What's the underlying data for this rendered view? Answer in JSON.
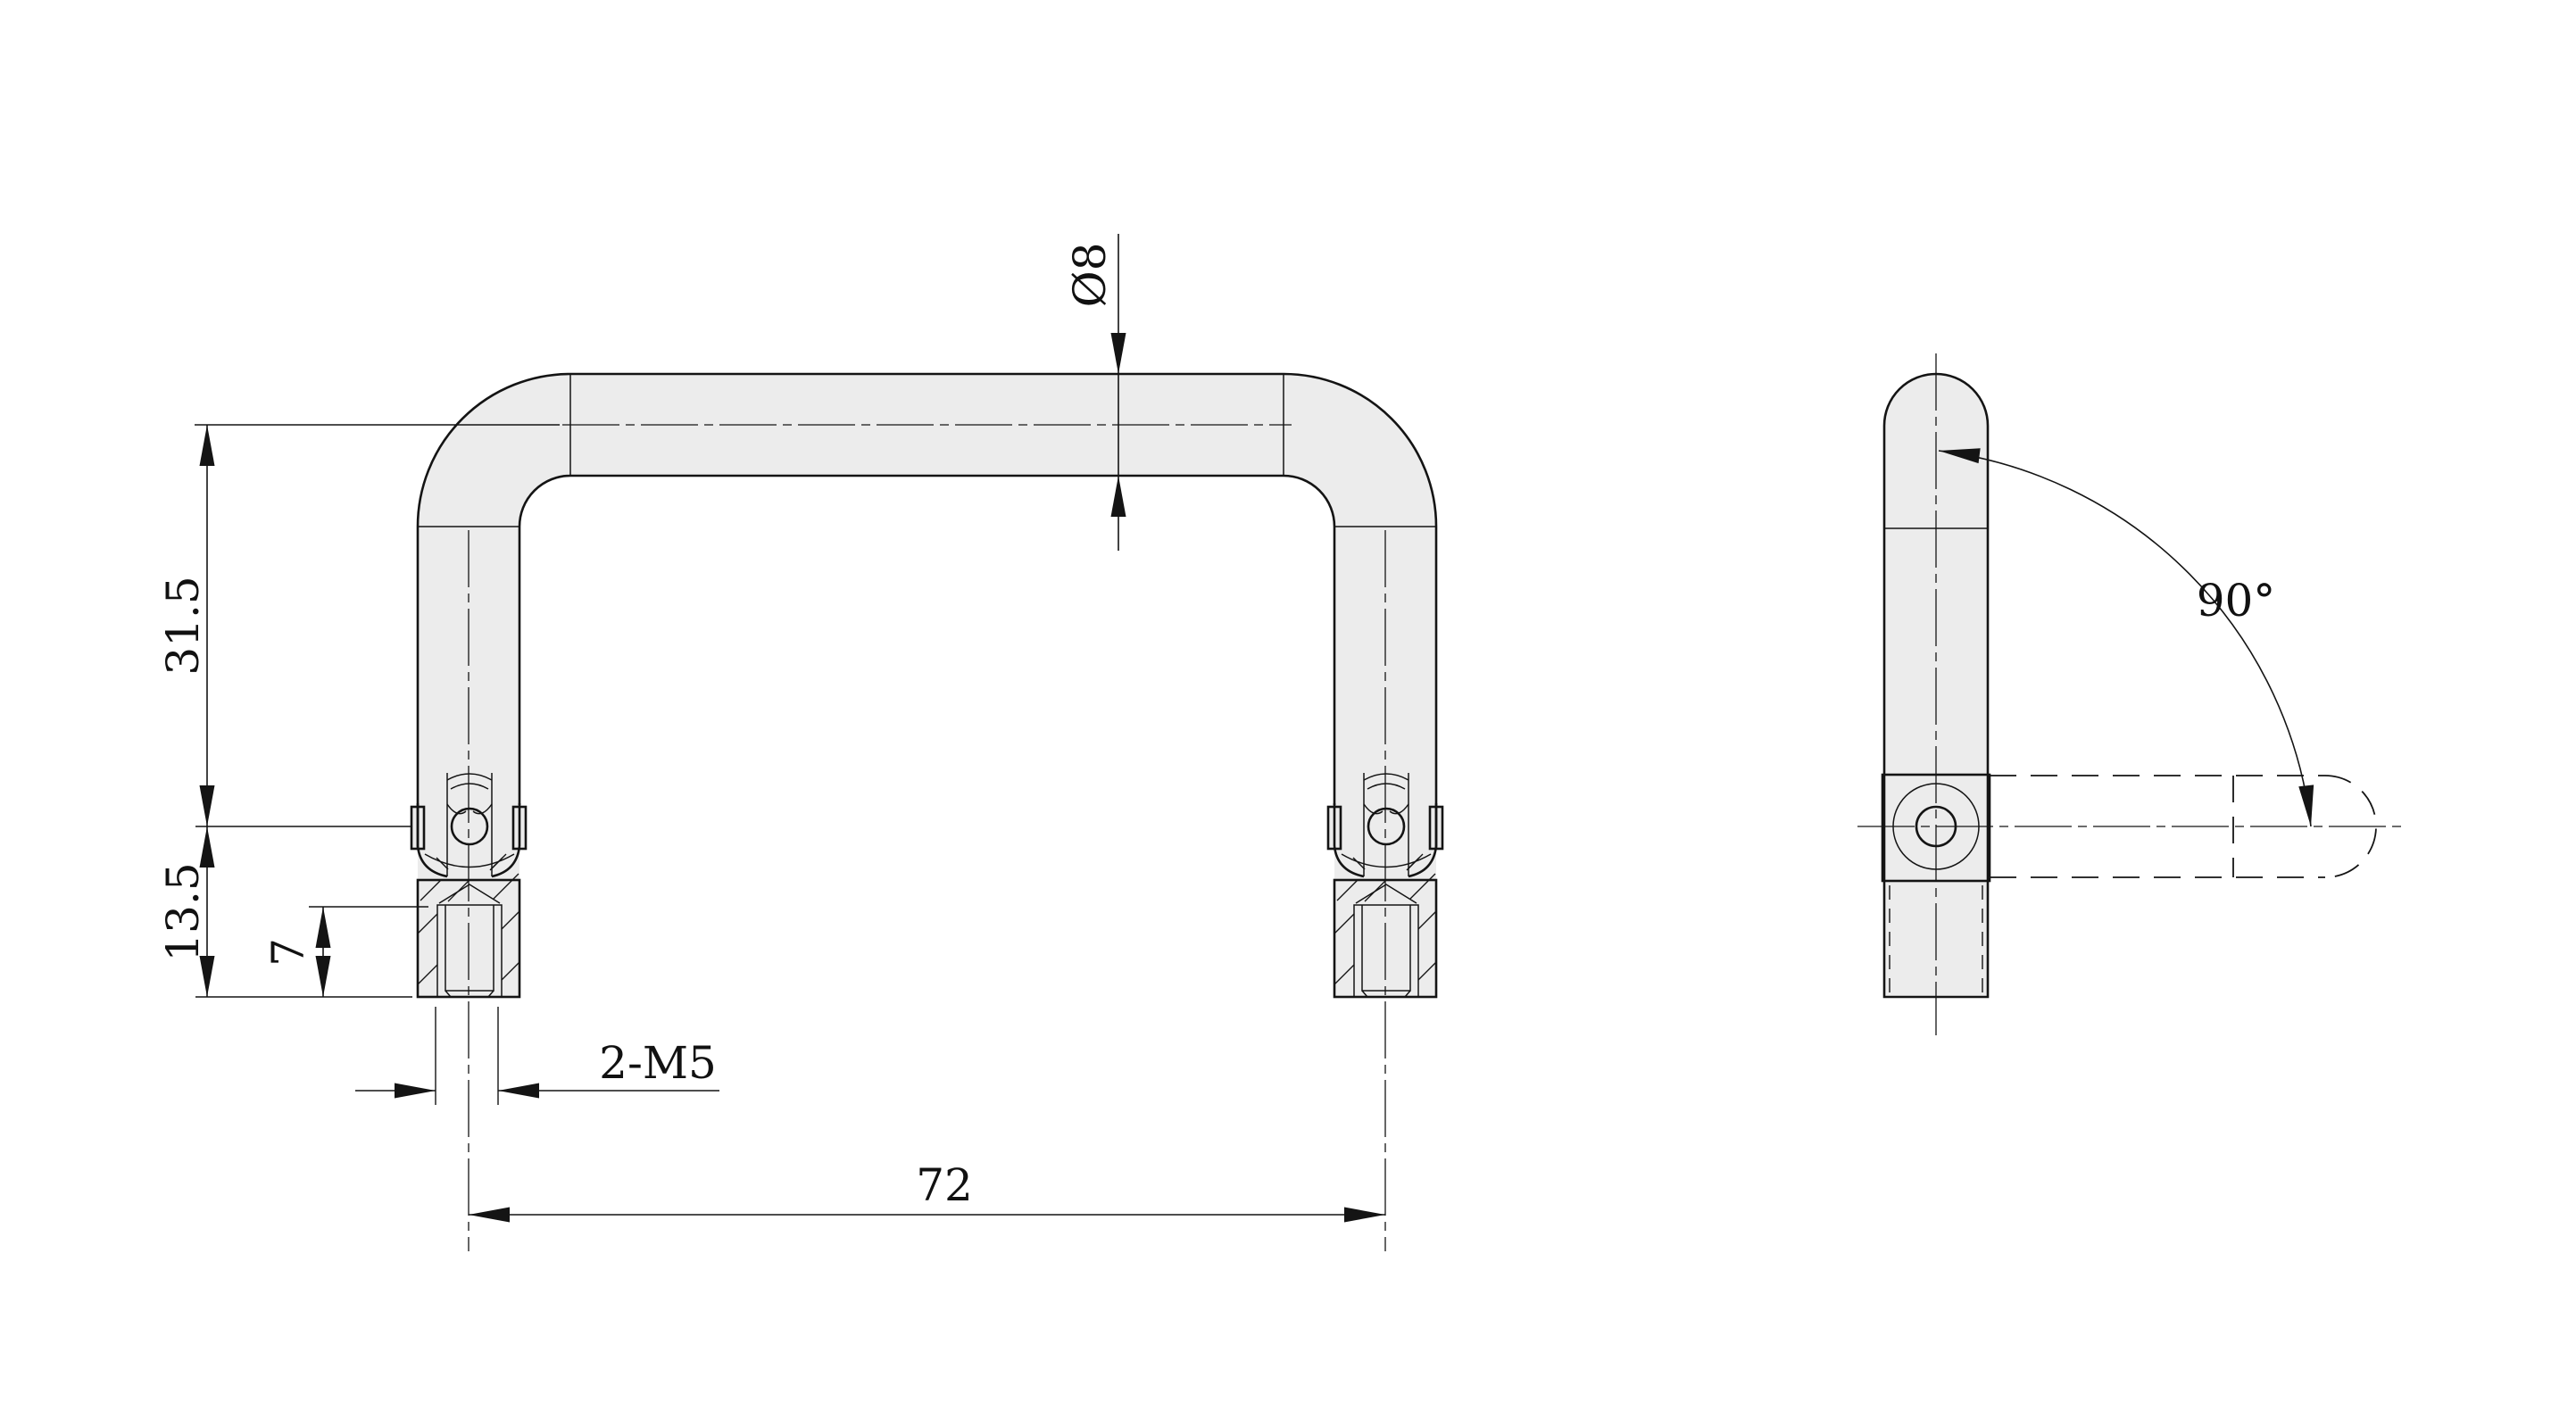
{
  "drawing": {
    "background_color": "#ffffff",
    "part_fill_color": "#ececec",
    "line_color": "#141414",
    "labels": {
      "tube_diameter": "Ø8",
      "upper_height": "31.5",
      "lower_height": "13.5",
      "thread_depth": "7",
      "thread_callout": "2-M5",
      "mount_spacing": "72",
      "swing_angle": "90°"
    }
  }
}
